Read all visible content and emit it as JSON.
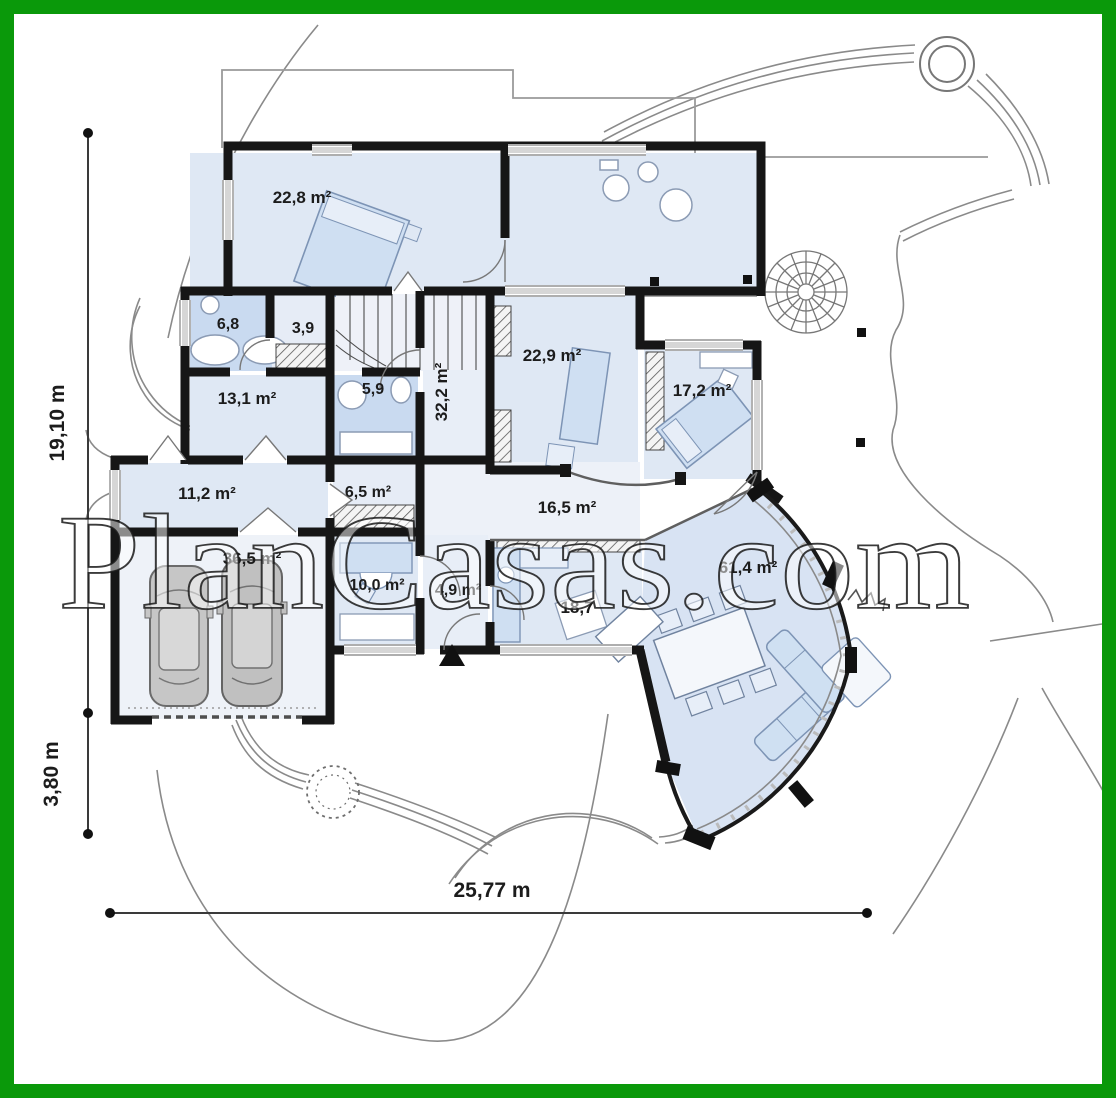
{
  "watermark": {
    "text": "PlanCasas.com"
  },
  "frame": {
    "border_color": "#0a990a"
  },
  "rooms": {
    "bedroom_top": "22,8 m²",
    "bath_top": "6,8",
    "closet": "3,9",
    "room_13_1": "13,1 m²",
    "bath_mid": "5,9",
    "hall_vertical": "32,2 m²",
    "bedroom_right": "22,9 m²",
    "bedroom_far_right": "17,2 m²",
    "utility_corridor": "11,2 m²",
    "hall_small": "6,5 m²",
    "room_16_5": "16,5 m²",
    "garage": "36,5 m²",
    "office": "10,0 m²",
    "entry_hall": "4,9 m²",
    "kitchen": "18,7",
    "living_room": "61,4 m²"
  },
  "dimensions": {
    "left_main": "19,10 m",
    "left_garage": "3,80 m",
    "bottom": "25,77 m"
  }
}
